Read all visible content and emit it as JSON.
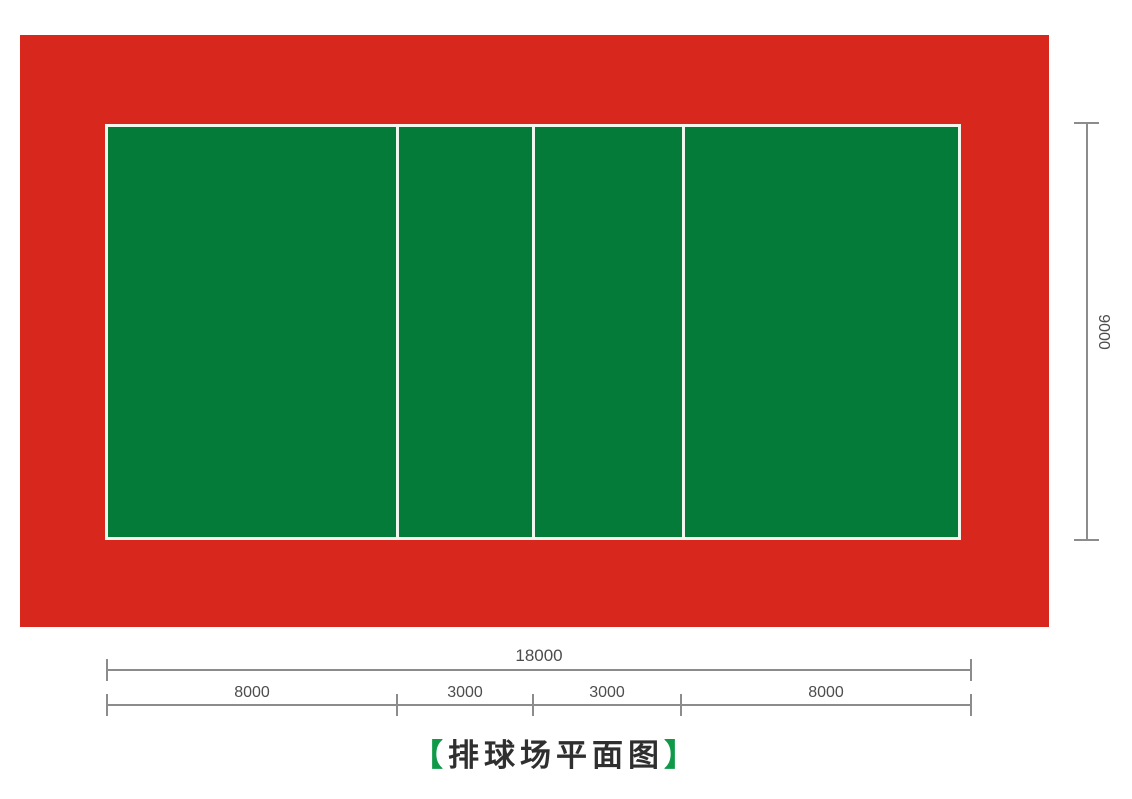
{
  "title": {
    "open_bracket": "【",
    "text": "排球场平面图",
    "close_bracket": "】"
  },
  "dimensions": {
    "total_length_label": "18000",
    "height_label": "9000",
    "segments": [
      {
        "label": "8000"
      },
      {
        "label": "3000"
      },
      {
        "label": "3000"
      },
      {
        "label": "8000"
      }
    ]
  },
  "colors": {
    "apron_red": "#d8281e",
    "court_green": "#047b39",
    "line_white": "#f1f7ef",
    "dimension_gray": "#8c8c8c",
    "dimension_text_gray": "#4d4d4d",
    "title_bracket_green": "#0f9a4a",
    "title_text": "#2f2f2f"
  },
  "diagram": {
    "type": "volleyball-court-plan",
    "total_length": 18000,
    "total_width": 9000,
    "segment_lengths": [
      8000,
      3000,
      3000,
      8000
    ]
  }
}
